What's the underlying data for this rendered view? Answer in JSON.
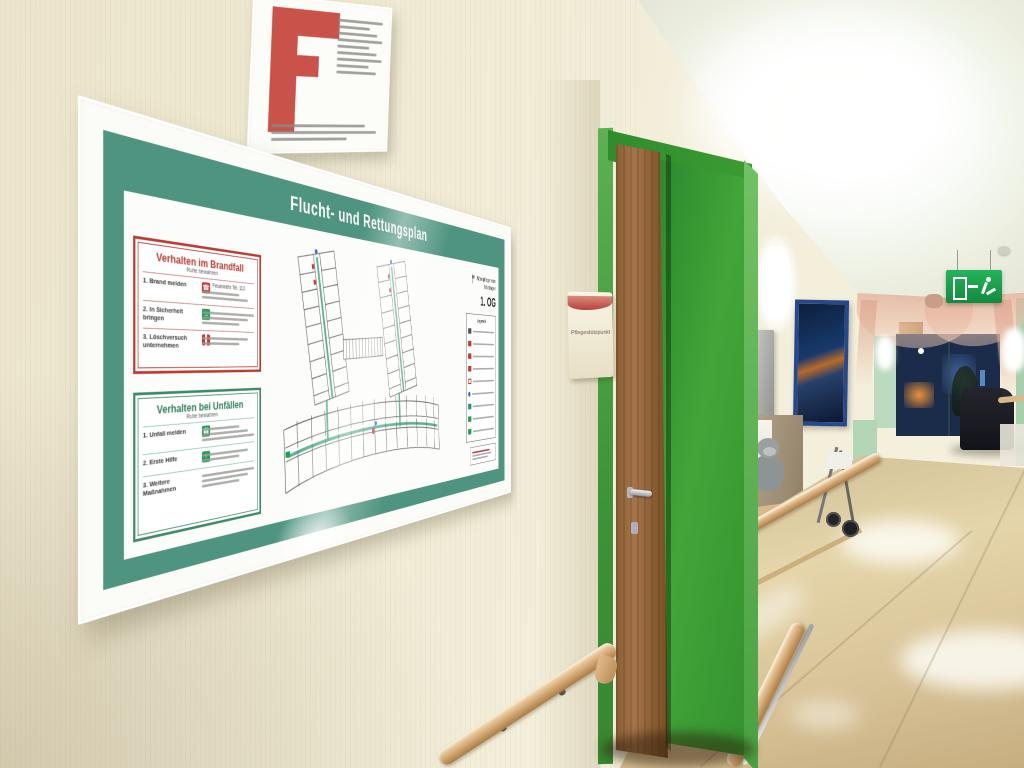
{
  "poster": {
    "title": "Flucht- und Rettungsplan",
    "facility_line1": "Altenpflegeheim",
    "facility_line2": "Nürtingen",
    "floor_label": "1. OG",
    "legend_title": "Legende",
    "legend_icons": [
      "info-point-icon",
      "fire-extinguisher-icon",
      "fire-alarm-button-icon",
      "wall-hydrant-icon",
      "fire-door-icon",
      "your-location-icon",
      "escape-route-icon",
      "emergency-exit-icon",
      "assembly-point-icon"
    ],
    "icons": {
      "phone": "☎",
      "plus": "+",
      "arrow": "→"
    },
    "fire_box": {
      "title": "Verhalten im Brandfall",
      "subtitle": "Ruhe bewahren",
      "items": [
        {
          "num": "1.",
          "label": "Brand melden",
          "detail": "Feuerwehr Tel. 112"
        },
        {
          "num": "2.",
          "label": "In Sicherheit bringen"
        },
        {
          "num": "3.",
          "label": "Löschversuch unternehmen"
        }
      ]
    },
    "accident_box": {
      "title": "Verhalten bei Unfällen",
      "subtitle": "Ruhe bewahren",
      "items": [
        {
          "num": "1.",
          "label": "Unfall melden"
        },
        {
          "num": "2.",
          "label": "Erste Hilfe"
        },
        {
          "num": "3.",
          "label": "Weitere Maßnahmen"
        }
      ]
    }
  },
  "door_sign": {
    "label": "Pflegestützpunkt"
  },
  "signs": {
    "exit_sign_icon": "emergency-exit-running-man-icon",
    "fire_notice_icon": "fire-safety-notice-icon"
  },
  "colors": {
    "door_green": "#3f9b3c",
    "poster_green": "#4e9480",
    "safety_red": "#c0392b",
    "exit_green": "#1ea04e",
    "wall_cream": "#f1ecd4",
    "floor_beige": "#d9c69c"
  }
}
